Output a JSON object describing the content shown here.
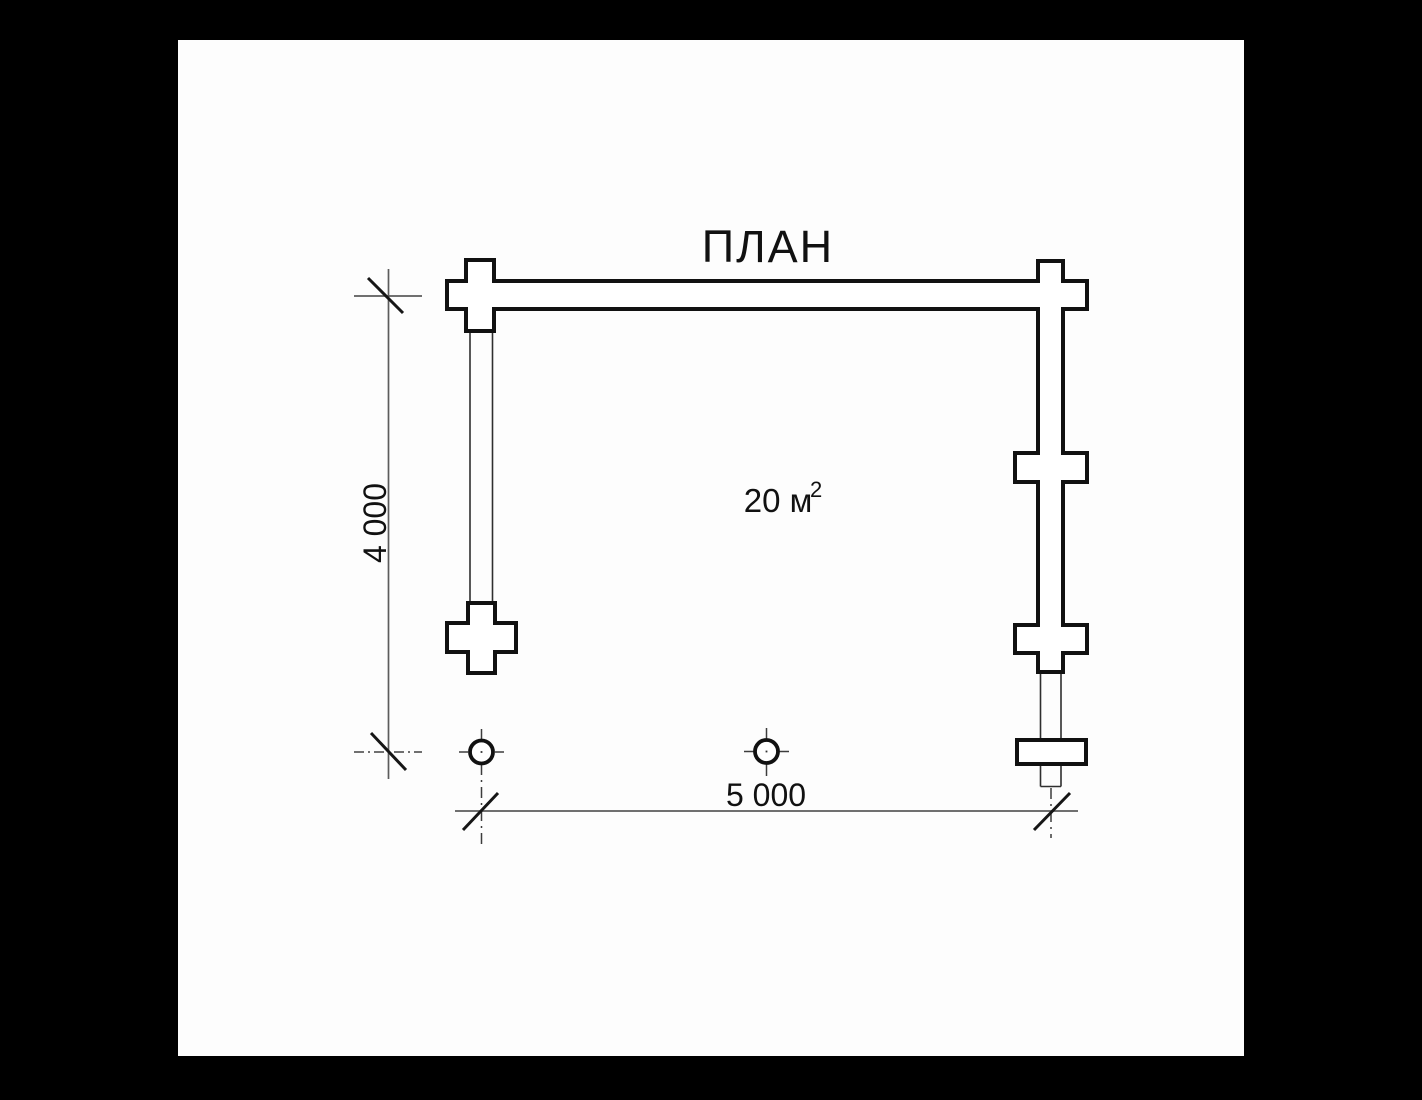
{
  "title": "ПЛАН",
  "drawing": {
    "area_label": "20 м",
    "area_sup": "2",
    "dim_horizontal": "5 000",
    "dim_vertical": "4 000"
  },
  "colors": {
    "paper": "#fdfdfd",
    "letterbox": "#000000",
    "ink": "#111111",
    "thin_line": "#2f2f2f",
    "dimension_gray": "#5c5c5c"
  }
}
